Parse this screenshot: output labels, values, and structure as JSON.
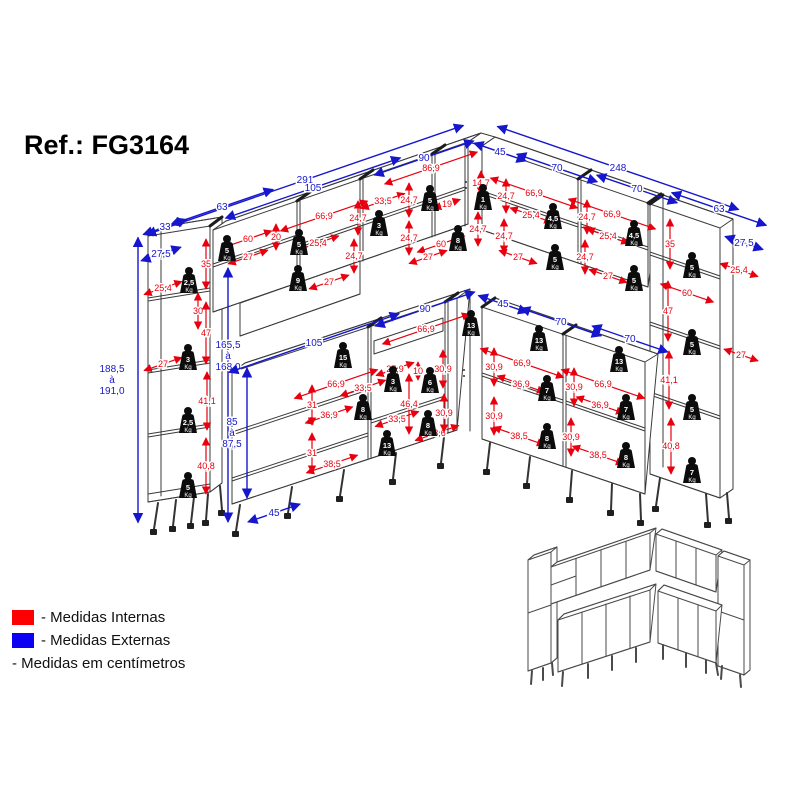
{
  "title": "Ref.: FG3164",
  "legend": {
    "internal_label": "- Medidas Internas",
    "external_label": "- Medidas Externas",
    "unit_note": "- Medidas em centímetros"
  },
  "colors": {
    "internal": "#e8000e",
    "external": "#1616cd",
    "legend_red": "#fd0002",
    "legend_blue": "#0b01f2"
  },
  "weight_unit": "Kg",
  "dims": [
    {
      "t": "291",
      "x": 305,
      "y": 180,
      "c": "b",
      "a": -19,
      "l": 335
    },
    {
      "t": "105",
      "x": 313,
      "y": 188,
      "c": "b",
      "a": -19,
      "l": 185
    },
    {
      "t": "63",
      "x": 222,
      "y": 207,
      "c": "b",
      "a": -19,
      "l": 108
    },
    {
      "t": "33",
      "x": 165,
      "y": 227,
      "c": "b",
      "a": -19,
      "l": 46
    },
    {
      "t": "27,5",
      "x": 161,
      "y": 254,
      "c": "b",
      "a": -19,
      "l": 42
    },
    {
      "t": "90",
      "x": 424,
      "y": 158,
      "c": "b",
      "a": -19,
      "l": 105
    },
    {
      "t": "45",
      "x": 500,
      "y": 152,
      "c": "b",
      "a": 19,
      "l": 55
    },
    {
      "t": "70",
      "x": 557,
      "y": 168,
      "c": "b",
      "a": 19,
      "l": 85
    },
    {
      "t": "248",
      "x": 618,
      "y": 168,
      "c": "b",
      "a": 19,
      "l": 255
    },
    {
      "t": "70",
      "x": 637,
      "y": 189,
      "c": "b",
      "a": 19,
      "l": 85
    },
    {
      "t": "63",
      "x": 719,
      "y": 209,
      "c": "b",
      "a": 19,
      "l": 100
    },
    {
      "t": "27,5",
      "x": 744,
      "y": 243,
      "c": "b",
      "a": 19,
      "l": 40
    },
    {
      "t": "188,5\nà\n191,0",
      "x": 138,
      "y": 380,
      "c": "b",
      "a": 90,
      "l": 285,
      "ox": -26
    },
    {
      "t": "165,5\nà\n168,0",
      "x": 228,
      "y": 395,
      "c": "b",
      "a": 90,
      "l": 254,
      "oy": -39
    },
    {
      "t": "85\nà\n87,5",
      "x": 247,
      "y": 433,
      "c": "b",
      "a": 90,
      "l": 130,
      "ox": -15
    },
    {
      "t": "45",
      "x": 274,
      "y": 513,
      "c": "b",
      "a": -19,
      "l": 55
    },
    {
      "t": "90",
      "x": 425,
      "y": 309,
      "c": "b",
      "a": -19,
      "l": 105
    },
    {
      "t": "45",
      "x": 503,
      "y": 304,
      "c": "b",
      "a": 19,
      "l": 52
    },
    {
      "t": "70",
      "x": 561,
      "y": 322,
      "c": "b",
      "a": 19,
      "l": 85
    },
    {
      "t": "70",
      "x": 630,
      "y": 339,
      "c": "b",
      "a": 19,
      "l": 80
    },
    {
      "t": "105",
      "x": 314,
      "y": 343,
      "c": "b",
      "a": -19,
      "l": 180
    },
    {
      "t": "25,4",
      "x": 163,
      "y": 288,
      "c": "r",
      "a": -19,
      "l": 40
    },
    {
      "t": "35",
      "x": 206,
      "y": 264,
      "c": "r",
      "a": 90,
      "l": 50
    },
    {
      "t": "30",
      "x": 198,
      "y": 311,
      "c": "r",
      "a": 90,
      "l": 36
    },
    {
      "t": "47",
      "x": 206,
      "y": 333,
      "c": "r",
      "a": 90,
      "l": 62
    },
    {
      "t": "27",
      "x": 163,
      "y": 364,
      "c": "r",
      "a": -19,
      "l": 40
    },
    {
      "t": "41,1",
      "x": 207,
      "y": 401,
      "c": "r",
      "a": 90,
      "l": 58
    },
    {
      "t": "40,8",
      "x": 206,
      "y": 466,
      "c": "r",
      "a": 90,
      "l": 56
    },
    {
      "t": "60",
      "x": 248,
      "y": 239,
      "c": "r",
      "a": -19,
      "l": 50
    },
    {
      "t": "20",
      "x": 276,
      "y": 237,
      "c": "r",
      "a": 90,
      "l": 26
    },
    {
      "t": "27",
      "x": 248,
      "y": 257,
      "c": "r",
      "a": -19,
      "l": 42
    },
    {
      "t": "66,9",
      "x": 324,
      "y": 216,
      "c": "r",
      "a": -19,
      "l": 92
    },
    {
      "t": "25,4",
      "x": 318,
      "y": 243,
      "c": "r",
      "a": -19,
      "l": 44
    },
    {
      "t": "24,7",
      "x": 358,
      "y": 218,
      "c": "r",
      "a": 90,
      "l": 34
    },
    {
      "t": "33,5",
      "x": 383,
      "y": 201,
      "c": "r",
      "a": -19,
      "l": 46
    },
    {
      "t": "24,7",
      "x": 354,
      "y": 256,
      "c": "r",
      "a": 90,
      "l": 34
    },
    {
      "t": "27",
      "x": 329,
      "y": 282,
      "c": "r",
      "a": -19,
      "l": 42
    },
    {
      "t": "86,9",
      "x": 431,
      "y": 168,
      "c": "r",
      "a": -19,
      "l": 98
    },
    {
      "t": "24,7",
      "x": 409,
      "y": 200,
      "c": "r",
      "a": 90,
      "l": 34
    },
    {
      "t": "19",
      "x": 447,
      "y": 204,
      "c": "r",
      "a": -19,
      "l": 28
    },
    {
      "t": "14,7",
      "x": 481,
      "y": 183,
      "c": "r",
      "a": 90,
      "l": 24
    },
    {
      "t": "24,7",
      "x": 409,
      "y": 238,
      "c": "r",
      "a": 90,
      "l": 34
    },
    {
      "t": "60",
      "x": 441,
      "y": 244,
      "c": "r",
      "a": -19,
      "l": 50
    },
    {
      "t": "27",
      "x": 428,
      "y": 257,
      "c": "r",
      "a": -19,
      "l": 40
    },
    {
      "t": "24,7",
      "x": 478,
      "y": 229,
      "c": "r",
      "a": 90,
      "l": 34
    },
    {
      "t": "24,7",
      "x": 506,
      "y": 196,
      "c": "r",
      "a": 90,
      "l": 34
    },
    {
      "t": "66,9",
      "x": 534,
      "y": 193,
      "c": "r",
      "a": 19,
      "l": 92
    },
    {
      "t": "25,4",
      "x": 531,
      "y": 215,
      "c": "r",
      "a": 19,
      "l": 44
    },
    {
      "t": "24,7",
      "x": 504,
      "y": 236,
      "c": "r",
      "a": 90,
      "l": 34
    },
    {
      "t": "27",
      "x": 518,
      "y": 257,
      "c": "r",
      "a": 19,
      "l": 40
    },
    {
      "t": "24,7",
      "x": 587,
      "y": 217,
      "c": "r",
      "a": 90,
      "l": 34
    },
    {
      "t": "66,9",
      "x": 612,
      "y": 214,
      "c": "r",
      "a": 19,
      "l": 92
    },
    {
      "t": "25,4",
      "x": 608,
      "y": 236,
      "c": "r",
      "a": 19,
      "l": 44
    },
    {
      "t": "24,7",
      "x": 585,
      "y": 257,
      "c": "r",
      "a": 90,
      "l": 34
    },
    {
      "t": "27",
      "x": 608,
      "y": 276,
      "c": "r",
      "a": 19,
      "l": 40
    },
    {
      "t": "35",
      "x": 670,
      "y": 244,
      "c": "r",
      "a": 90,
      "l": 50
    },
    {
      "t": "25,4",
      "x": 739,
      "y": 270,
      "c": "r",
      "a": 19,
      "l": 40
    },
    {
      "t": "60",
      "x": 687,
      "y": 293,
      "c": "r",
      "a": 19,
      "l": 56
    },
    {
      "t": "47",
      "x": 668,
      "y": 311,
      "c": "r",
      "a": 90,
      "l": 60
    },
    {
      "t": "27",
      "x": 741,
      "y": 355,
      "c": "r",
      "a": 19,
      "l": 36
    },
    {
      "t": "41,1",
      "x": 669,
      "y": 380,
      "c": "r",
      "a": 90,
      "l": 58
    },
    {
      "t": "40,8",
      "x": 671,
      "y": 446,
      "c": "r",
      "a": 90,
      "l": 56
    },
    {
      "t": "66,9",
      "x": 426,
      "y": 329,
      "c": "r",
      "a": -19,
      "l": 92
    },
    {
      "t": "66,9",
      "x": 336,
      "y": 384,
      "c": "r",
      "a": -19,
      "l": 88
    },
    {
      "t": "33,5",
      "x": 363,
      "y": 388,
      "c": "r",
      "a": -19,
      "l": 48
    },
    {
      "t": "31",
      "x": 312,
      "y": 405,
      "c": "r",
      "a": 90,
      "l": 40
    },
    {
      "t": "36,9",
      "x": 329,
      "y": 415,
      "c": "r",
      "a": -19,
      "l": 50
    },
    {
      "t": "31",
      "x": 312,
      "y": 453,
      "c": "r",
      "a": 90,
      "l": 40
    },
    {
      "t": "38,5",
      "x": 332,
      "y": 464,
      "c": "r",
      "a": -19,
      "l": 54
    },
    {
      "t": "27,9",
      "x": 395,
      "y": 369,
      "c": "r",
      "a": -19,
      "l": 40
    },
    {
      "t": "10",
      "x": 418,
      "y": 371,
      "c": "r",
      "a": 90,
      "l": 18
    },
    {
      "t": "30,9",
      "x": 443,
      "y": 369,
      "c": "r",
      "a": 90,
      "l": 38
    },
    {
      "t": "46,4",
      "x": 409,
      "y": 404,
      "c": "r",
      "a": 90,
      "l": 60
    },
    {
      "t": "33,5",
      "x": 397,
      "y": 419,
      "c": "r",
      "a": -19,
      "l": 46
    },
    {
      "t": "33,6",
      "x": 437,
      "y": 433,
      "c": "r",
      "a": -19,
      "l": 46
    },
    {
      "t": "30,9",
      "x": 444,
      "y": 413,
      "c": "r",
      "a": 90,
      "l": 38
    },
    {
      "t": "30,9",
      "x": 494,
      "y": 367,
      "c": "r",
      "a": 90,
      "l": 38
    },
    {
      "t": "30,9",
      "x": 494,
      "y": 416,
      "c": "r",
      "a": 90,
      "l": 38
    },
    {
      "t": "66,9",
      "x": 522,
      "y": 363,
      "c": "r",
      "a": 19,
      "l": 88
    },
    {
      "t": "36,9",
      "x": 521,
      "y": 384,
      "c": "r",
      "a": 19,
      "l": 50
    },
    {
      "t": "30,9",
      "x": 574,
      "y": 387,
      "c": "r",
      "a": 90,
      "l": 38
    },
    {
      "t": "66,9",
      "x": 603,
      "y": 384,
      "c": "r",
      "a": 19,
      "l": 88
    },
    {
      "t": "36,9",
      "x": 600,
      "y": 405,
      "c": "r",
      "a": 19,
      "l": 50
    },
    {
      "t": "38,5",
      "x": 519,
      "y": 436,
      "c": "r",
      "a": 19,
      "l": 54
    },
    {
      "t": "30,9",
      "x": 571,
      "y": 437,
      "c": "r",
      "a": 90,
      "l": 38
    },
    {
      "t": "38,5",
      "x": 598,
      "y": 455,
      "c": "r",
      "a": 19,
      "l": 54
    }
  ],
  "weights": [
    {
      "x": 189,
      "y": 280,
      "kg": "2,5"
    },
    {
      "x": 188,
      "y": 357,
      "kg": "3"
    },
    {
      "x": 188,
      "y": 420,
      "kg": "2,5"
    },
    {
      "x": 188,
      "y": 485,
      "kg": "5"
    },
    {
      "x": 227,
      "y": 248,
      "kg": "5"
    },
    {
      "x": 299,
      "y": 242,
      "kg": "5"
    },
    {
      "x": 298,
      "y": 278,
      "kg": "9"
    },
    {
      "x": 379,
      "y": 223,
      "kg": "3"
    },
    {
      "x": 430,
      "y": 198,
      "kg": "5"
    },
    {
      "x": 483,
      "y": 197,
      "kg": "1"
    },
    {
      "x": 458,
      "y": 238,
      "kg": "8"
    },
    {
      "x": 553,
      "y": 216,
      "kg": "4,5"
    },
    {
      "x": 555,
      "y": 257,
      "kg": "5"
    },
    {
      "x": 634,
      "y": 233,
      "kg": "4,5"
    },
    {
      "x": 634,
      "y": 278,
      "kg": "5"
    },
    {
      "x": 692,
      "y": 265,
      "kg": "5"
    },
    {
      "x": 692,
      "y": 342,
      "kg": "5"
    },
    {
      "x": 692,
      "y": 407,
      "kg": "5"
    },
    {
      "x": 692,
      "y": 470,
      "kg": "7"
    },
    {
      "x": 343,
      "y": 355,
      "kg": "15"
    },
    {
      "x": 471,
      "y": 323,
      "kg": "13"
    },
    {
      "x": 393,
      "y": 379,
      "kg": "3"
    },
    {
      "x": 430,
      "y": 380,
      "kg": "6"
    },
    {
      "x": 363,
      "y": 407,
      "kg": "8"
    },
    {
      "x": 428,
      "y": 423,
      "kg": "8"
    },
    {
      "x": 387,
      "y": 443,
      "kg": "13"
    },
    {
      "x": 539,
      "y": 338,
      "kg": "13"
    },
    {
      "x": 619,
      "y": 359,
      "kg": "13"
    },
    {
      "x": 547,
      "y": 388,
      "kg": "7"
    },
    {
      "x": 626,
      "y": 407,
      "kg": "7"
    },
    {
      "x": 547,
      "y": 436,
      "kg": "8"
    },
    {
      "x": 626,
      "y": 455,
      "kg": "8"
    }
  ]
}
